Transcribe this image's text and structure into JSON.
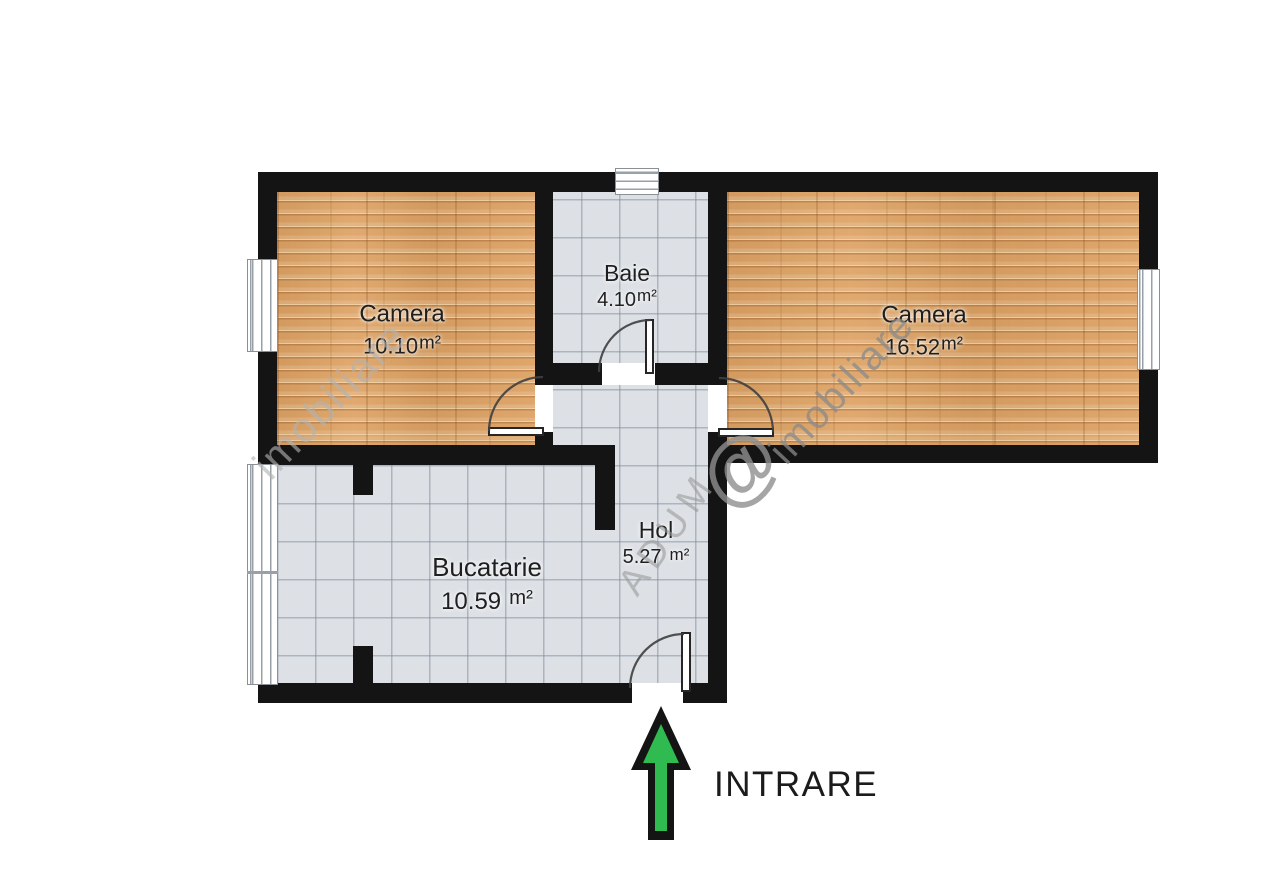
{
  "plan": {
    "rooms": [
      {
        "id": "camera-left",
        "name": "Camera",
        "area": "10.10",
        "unit": "m²"
      },
      {
        "id": "baie",
        "name": "Baie",
        "area": "4.10",
        "unit": "m²"
      },
      {
        "id": "camera-right",
        "name": "Camera",
        "area": "16.52",
        "unit": "m²"
      },
      {
        "id": "bucatarie",
        "name": "Bucatarie",
        "area": "10.59",
        "unit": "m²"
      },
      {
        "id": "hol",
        "name": "Hol",
        "area": "5.27",
        "unit": "m²"
      }
    ],
    "entrance": {
      "label": "INTRARE"
    },
    "watermark": {
      "primary": "imobiliare",
      "secondary": "imobiliare",
      "diagonal_text": "ADUM",
      "logo_glyph": "@"
    },
    "colors": {
      "wall": "#141414",
      "wood_floor": "#dda263",
      "tile_floor": "#dde1e6",
      "tile_line": "#7d8898",
      "arrow_green": "#2fbb4f",
      "label_text": "#1f1f1f"
    }
  }
}
